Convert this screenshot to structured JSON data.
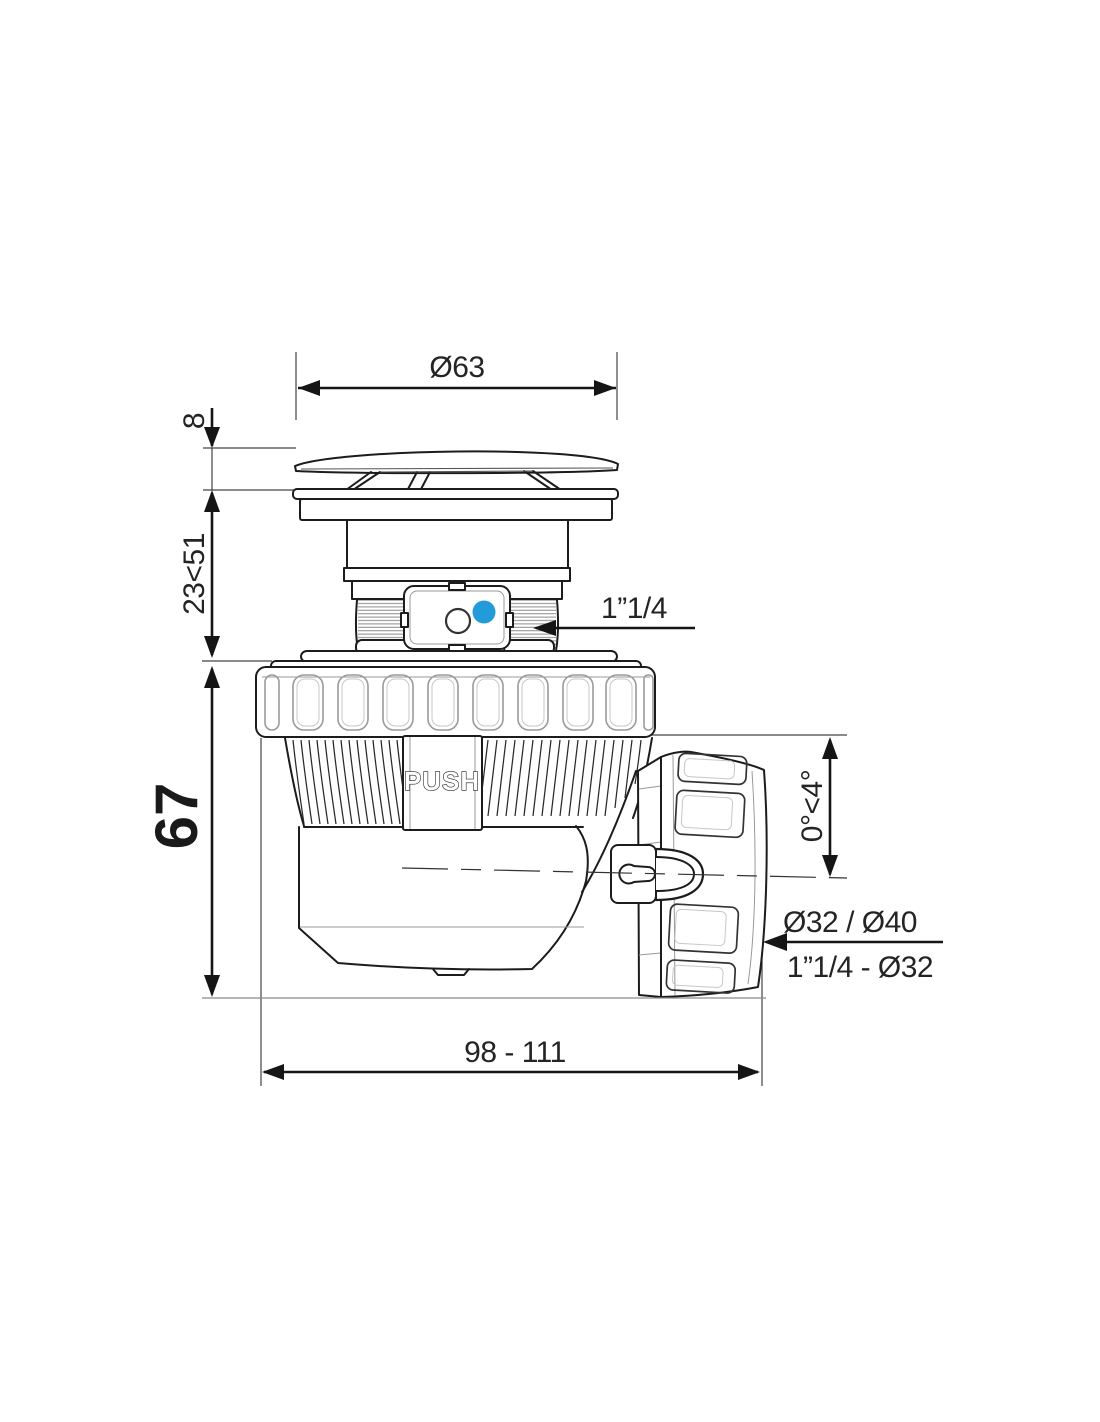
{
  "drawing": {
    "colors": {
      "line": "#1c1c1c",
      "accent_blue": "#239bd8"
    },
    "labels": {
      "push": "PUSH"
    },
    "dimensions": {
      "cap_diameter": "Ø63",
      "cap_lip_height": "8",
      "height_adjustment_range": "23<51",
      "body_height": "67",
      "inlet_thread": "1”1/4",
      "outlet_angle": "0°<4°",
      "outlet_connection_top": "Ø32 / Ø40",
      "outlet_connection_bottom": "1”1/4 - Ø32",
      "overall_length_range": "98 - 111"
    }
  }
}
